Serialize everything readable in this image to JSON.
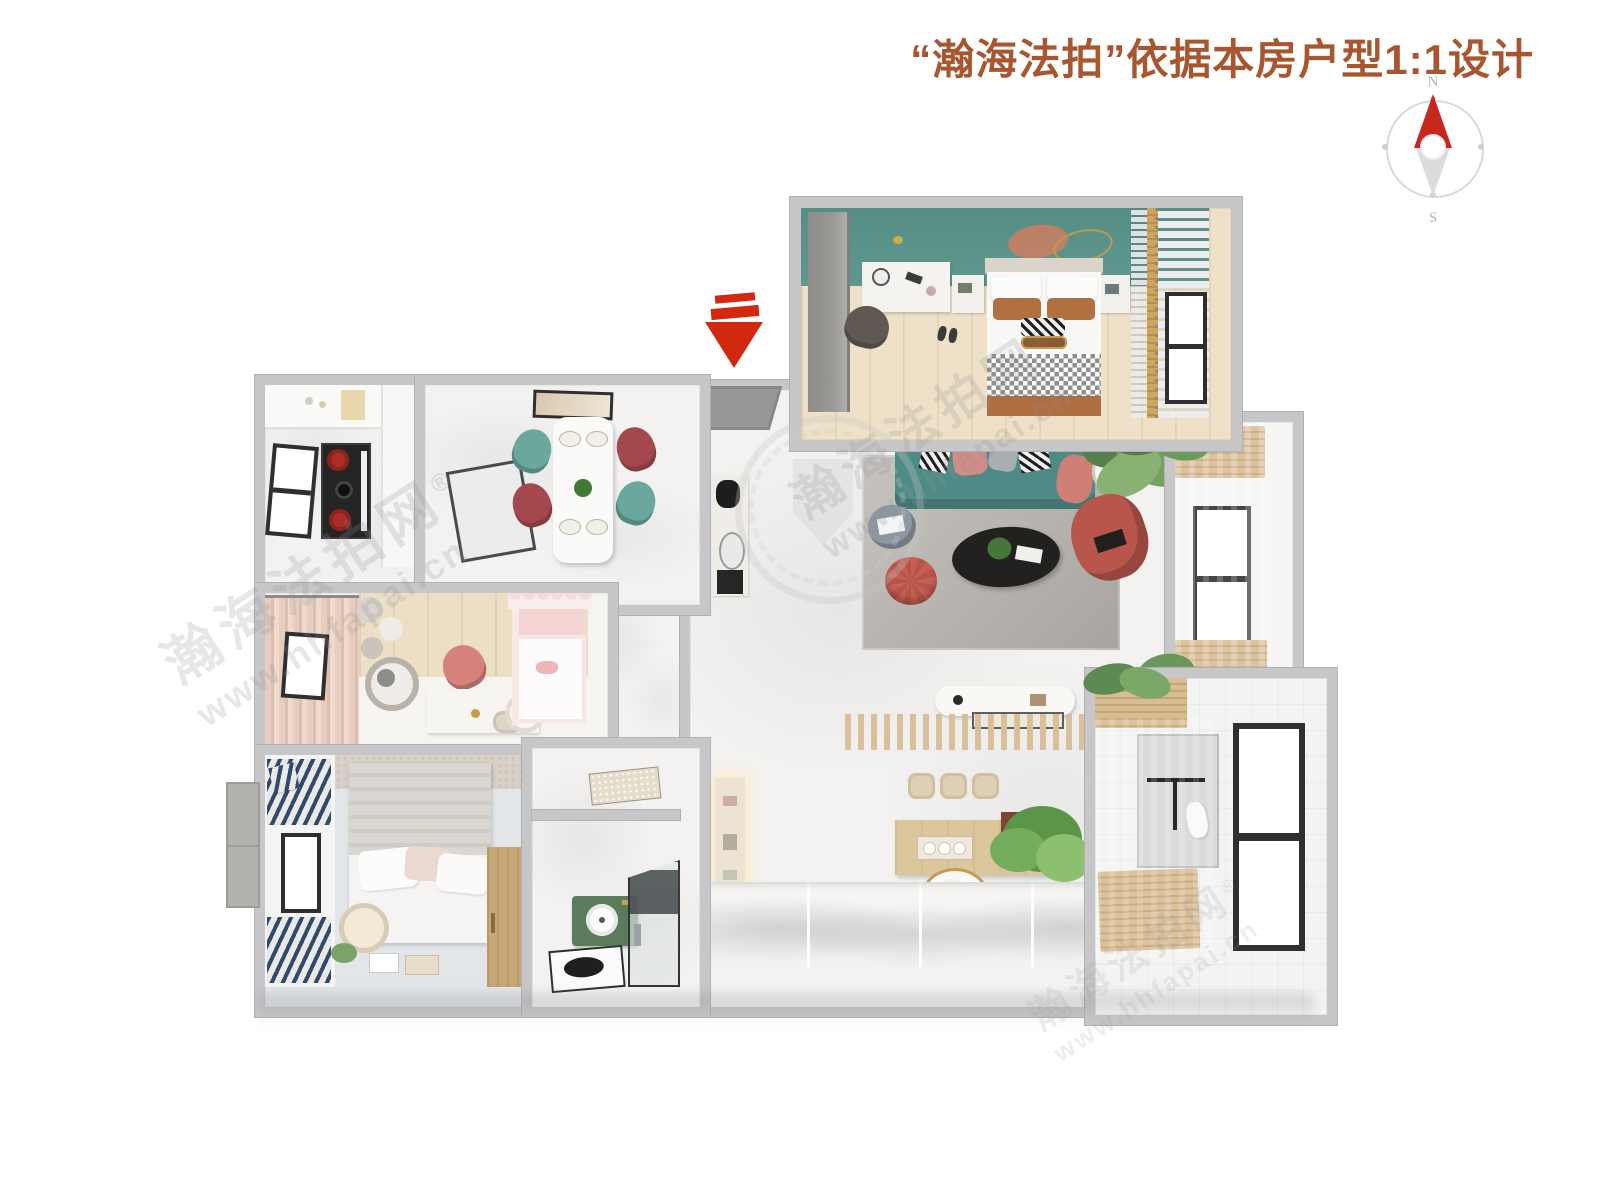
{
  "header": {
    "title": "“瀚海法拍”依据本房户型1:1设计"
  },
  "compass": {
    "north": "N",
    "south": "S"
  },
  "watermark": {
    "brand": "瀚海法拍网",
    "registered": "®",
    "url": "www.hhfapai.cn"
  },
  "palette": {
    "title_color": "#a8562f",
    "arrow_red": "#d2290e",
    "compass_red": "#c6281e",
    "wall_gray": "#c7c7c9",
    "wall_edge": "#b1b1b3",
    "marble_floor": "#f3f2f0",
    "accent_teal": "#5e988e",
    "sofa_teal": "#4f8b86",
    "coral": "#b8564b",
    "wood_light": "#e6d3b3"
  }
}
